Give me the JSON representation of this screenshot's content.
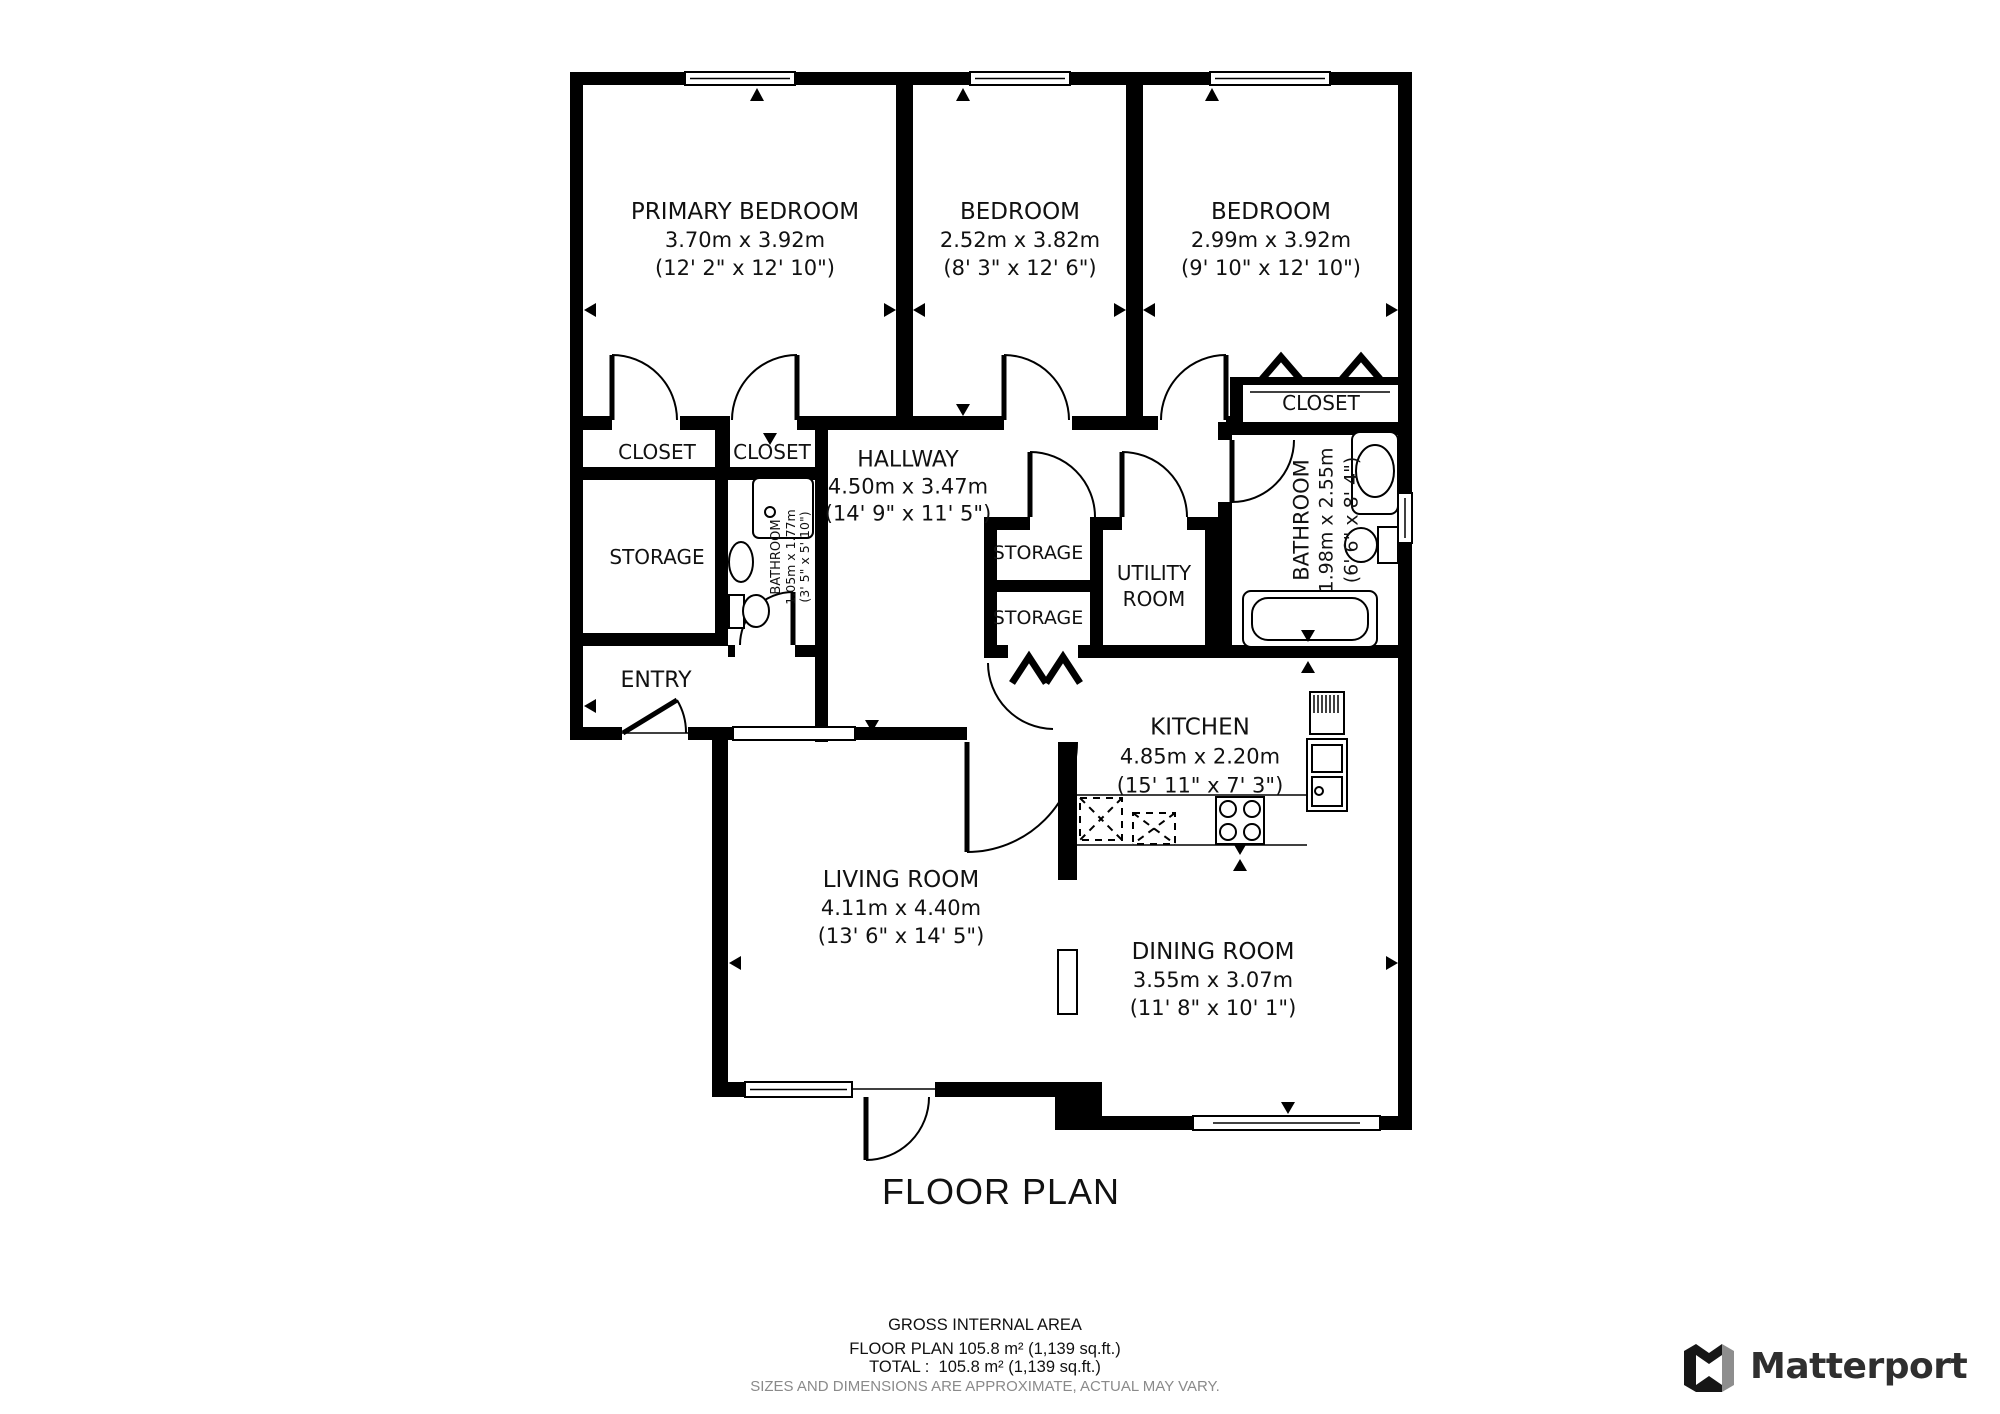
{
  "plan": {
    "title": "FLOOR PLAN",
    "rooms": {
      "primary_bedroom": {
        "name": "PRIMARY BEDROOM",
        "metric": "3.70m x 3.92m",
        "imperial": "(12' 2\" x 12' 10\")"
      },
      "bedroom_2": {
        "name": "BEDROOM",
        "metric": "2.52m x 3.82m",
        "imperial": "(8' 3\" x 12' 6\")"
      },
      "bedroom_3": {
        "name": "BEDROOM",
        "metric": "2.99m x 3.92m",
        "imperial": "(9' 10\" x 12' 10\")"
      },
      "hallway": {
        "name": "HALLWAY",
        "metric": "4.50m x 3.47m",
        "imperial": "(14' 9\" x 11' 5\")"
      },
      "bathroom_hall": {
        "name": "BATHROOM",
        "metric": "1.05m x 1.77m",
        "imperial": "(3' 5\" x 5' 10\")"
      },
      "bathroom_main": {
        "name": "BATHROOM",
        "metric": "1.98m x 2.55m",
        "imperial": "(6' 6\" x 8' 4\")"
      },
      "kitchen": {
        "name": "KITCHEN",
        "metric": "4.85m x 2.20m",
        "imperial": "(15' 11\" x 7' 3\")"
      },
      "living_room": {
        "name": "LIVING ROOM",
        "metric": "4.11m x 4.40m",
        "imperial": "(13' 6\" x 14' 5\")"
      },
      "dining_room": {
        "name": "DINING ROOM",
        "metric": "3.55m x 3.07m",
        "imperial": "(11' 8\" x 10' 1\")"
      },
      "closet_1": {
        "name": "CLOSET"
      },
      "closet_2": {
        "name": "CLOSET"
      },
      "closet_3": {
        "name": "CLOSET"
      },
      "storage_left": {
        "name": "STORAGE"
      },
      "storage_mid_1": {
        "name": "STORAGE"
      },
      "storage_mid_2": {
        "name": "STORAGE"
      },
      "utility_room": {
        "name": "UTILITY ROOM"
      },
      "entry": {
        "name": "ENTRY"
      }
    }
  },
  "footer": {
    "area_heading": "GROSS INTERNAL AREA",
    "area_floor_plan": "FLOOR PLAN 105.8 m² (1,139 sq.ft.)",
    "area_total": "TOTAL :  105.8 m² (1,139 sq.ft.)",
    "disclaimer": "SIZES AND DIMENSIONS ARE APPROXIMATE, ACTUAL MAY VARY."
  },
  "branding": {
    "wordmark": "Matterport"
  }
}
